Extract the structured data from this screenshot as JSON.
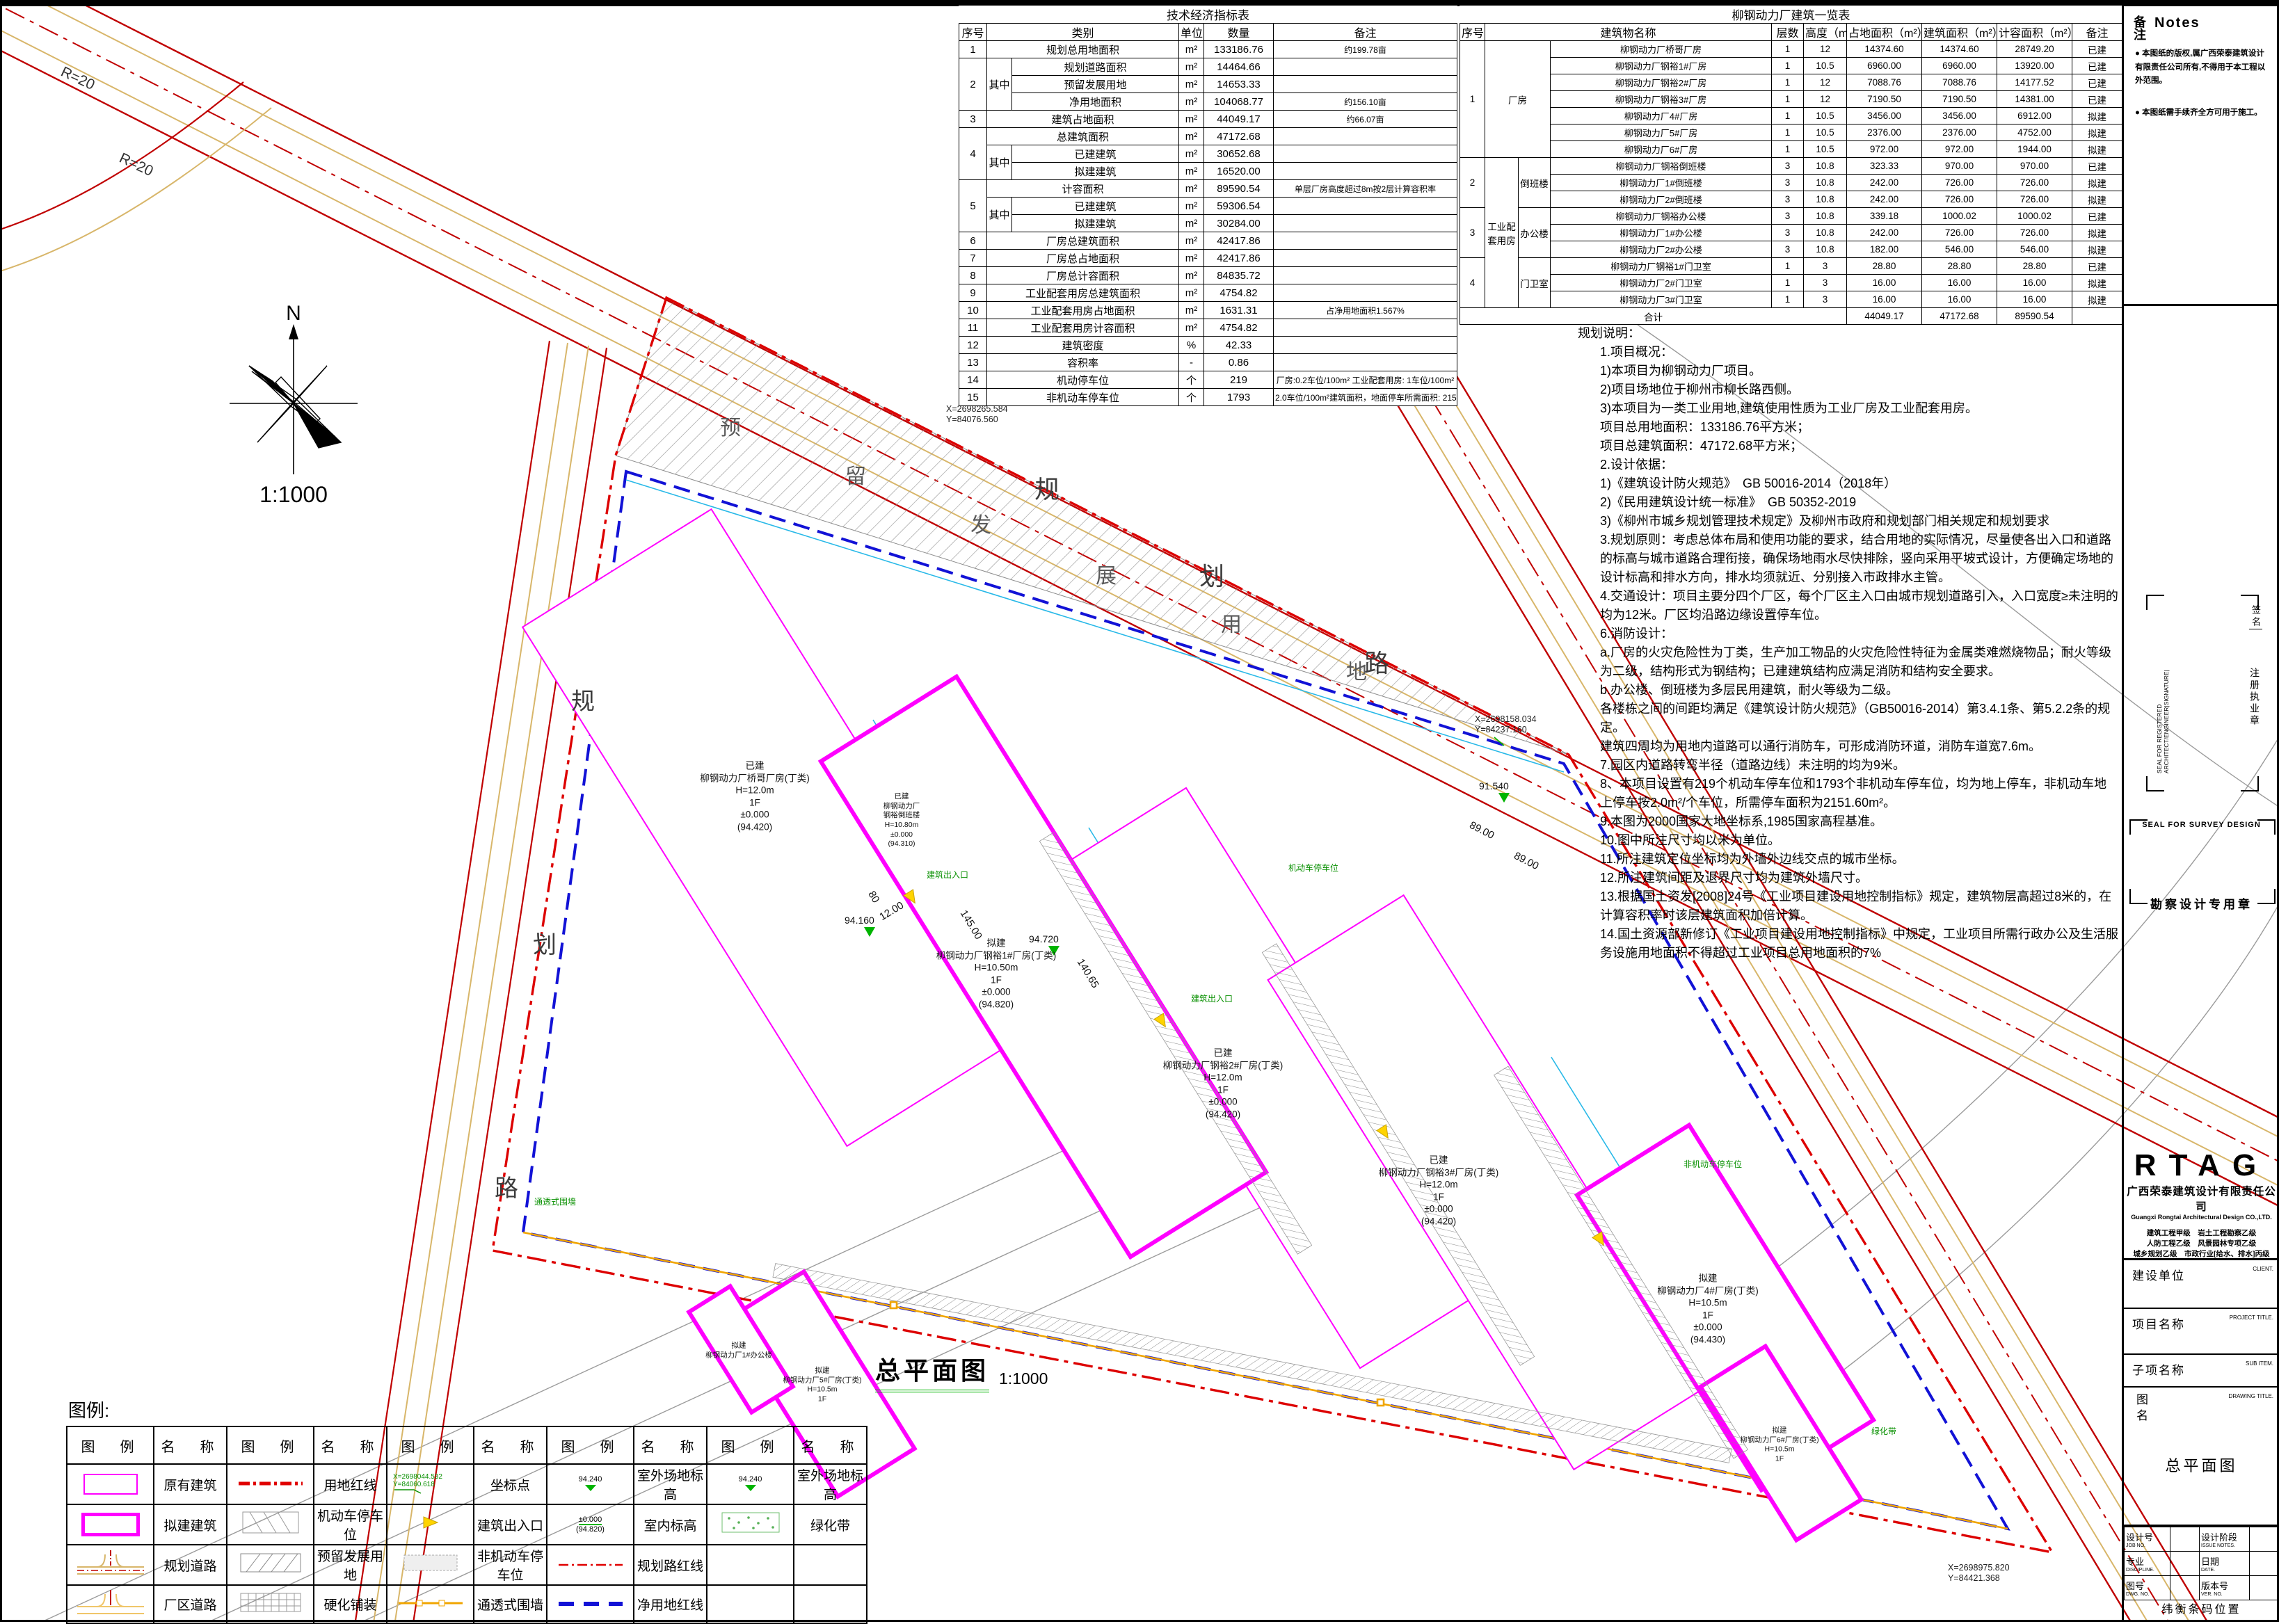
{
  "sheet": {
    "drawing_title": "总平面图",
    "drawing_scale": "1:1000",
    "north_label": "N",
    "compass_scale": "1:1000",
    "legend_title": "图例:",
    "accent_colors": {
      "existing_outline": "#ff00ff",
      "boundary_red": "#dd0000",
      "net_line_blue": "#1212d6",
      "dim_cyan": "#29b9e8",
      "elev_green": "#00b400",
      "road_tan": "#d8b66a"
    }
  },
  "t1": {
    "title": "技术经济指标表",
    "headers": {
      "no": "序号",
      "cat": "类别",
      "unit": "单位",
      "qty": "数量",
      "remark": "备注"
    },
    "rows": [
      {
        "no": "1",
        "sub": "",
        "name": "规划总用地面积",
        "unit": "m²",
        "qty": "133186.76",
        "remark": "约199.78亩"
      },
      {
        "no": "2",
        "sub": "其中",
        "name": "规划道路面积",
        "unit": "m²",
        "qty": "14464.66",
        "remark": ""
      },
      {
        "no": "",
        "sub": "",
        "name": "预留发展用地",
        "unit": "m²",
        "qty": "14653.33",
        "remark": ""
      },
      {
        "no": "",
        "sub": "",
        "name": "净用地面积",
        "unit": "m²",
        "qty": "104068.77",
        "remark": "约156.10亩"
      },
      {
        "no": "3",
        "sub": "",
        "name": "建筑占地面积",
        "unit": "m²",
        "qty": "44049.17",
        "remark": "约66.07亩"
      },
      {
        "no": "4",
        "sub": "",
        "name": "总建筑面积",
        "unit": "m²",
        "qty": "47172.68",
        "remark": ""
      },
      {
        "no": "",
        "sub": "其中",
        "name": "已建建筑",
        "unit": "m²",
        "qty": "30652.68",
        "remark": ""
      },
      {
        "no": "",
        "sub": "",
        "name": "拟建建筑",
        "unit": "m²",
        "qty": "16520.00",
        "remark": ""
      },
      {
        "no": "5",
        "sub": "",
        "name": "计容面积",
        "unit": "m²",
        "qty": "89590.54",
        "remark": "单层厂房高度超过8m按2层计算容积率"
      },
      {
        "no": "",
        "sub": "其中",
        "name": "已建建筑",
        "unit": "m²",
        "qty": "59306.54",
        "remark": ""
      },
      {
        "no": "",
        "sub": "",
        "name": "拟建建筑",
        "unit": "m²",
        "qty": "30284.00",
        "remark": ""
      },
      {
        "no": "6",
        "sub": "",
        "name": "厂房总建筑面积",
        "unit": "m²",
        "qty": "42417.86",
        "remark": ""
      },
      {
        "no": "7",
        "sub": "",
        "name": "厂房总占地面积",
        "unit": "m²",
        "qty": "42417.86",
        "remark": ""
      },
      {
        "no": "8",
        "sub": "",
        "name": "厂房总计容面积",
        "unit": "m²",
        "qty": "84835.72",
        "remark": ""
      },
      {
        "no": "9",
        "sub": "",
        "name": "工业配套用房总建筑面积",
        "unit": "m²",
        "qty": "4754.82",
        "remark": ""
      },
      {
        "no": "10",
        "sub": "",
        "name": "工业配套用房占地面积",
        "unit": "m²",
        "qty": "1631.31",
        "remark": "占净用地面积1.567%"
      },
      {
        "no": "11",
        "sub": "",
        "name": "工业配套用房计容面积",
        "unit": "m²",
        "qty": "4754.82",
        "remark": ""
      },
      {
        "no": "12",
        "sub": "",
        "name": "建筑密度",
        "unit": "%",
        "qty": "42.33",
        "remark": ""
      },
      {
        "no": "13",
        "sub": "",
        "name": "容积率",
        "unit": "-",
        "qty": "0.86",
        "remark": ""
      },
      {
        "no": "14",
        "sub": "",
        "name": "机动停车位",
        "unit": "个",
        "qty": "219",
        "remark": "厂房:0.2车位/100m²  工业配套用房: 1车位/100m²"
      },
      {
        "no": "15",
        "sub": "",
        "name": "非机动车停车位",
        "unit": "个",
        "qty": "1793",
        "remark": "2.0车位/100m²建筑面积，地面停车所需面积: 2151.60m²"
      }
    ]
  },
  "t2": {
    "title": "柳钢动力厂建筑一览表",
    "headers": {
      "no": "序号",
      "name": "建筑物名称",
      "floors": "层数",
      "height": "高度（m）",
      "occ": "占地面积（m²）",
      "gfa": "建筑面积（m²）",
      "far": "计容面积（m²）",
      "remark": "备注"
    },
    "groups": {
      "g1": "厂房",
      "g2": "工业配套用房",
      "s1": "倒班楼",
      "s2": "办公楼",
      "s3": "门卫室",
      "n1": "1",
      "n2": "2",
      "n3": "3",
      "n4": "4"
    },
    "rows": [
      {
        "name": "柳钢动力厂桥哥厂房",
        "floors": "1",
        "height": "12",
        "occ": "14374.60",
        "gfa": "14374.60",
        "far": "28749.20",
        "remark": "已建"
      },
      {
        "name": "柳钢动力厂钢裕1#厂房",
        "floors": "1",
        "height": "10.5",
        "occ": "6960.00",
        "gfa": "6960.00",
        "far": "13920.00",
        "remark": "已建"
      },
      {
        "name": "柳钢动力厂钢裕2#厂房",
        "floors": "1",
        "height": "12",
        "occ": "7088.76",
        "gfa": "7088.76",
        "far": "14177.52",
        "remark": "已建"
      },
      {
        "name": "柳钢动力厂钢裕3#厂房",
        "floors": "1",
        "height": "12",
        "occ": "7190.50",
        "gfa": "7190.50",
        "far": "14381.00",
        "remark": "已建"
      },
      {
        "name": "柳钢动力厂4#厂房",
        "floors": "1",
        "height": "10.5",
        "occ": "3456.00",
        "gfa": "3456.00",
        "far": "6912.00",
        "remark": "拟建"
      },
      {
        "name": "柳钢动力厂5#厂房",
        "floors": "1",
        "height": "10.5",
        "occ": "2376.00",
        "gfa": "2376.00",
        "far": "4752.00",
        "remark": "拟建"
      },
      {
        "name": "柳钢动力厂6#厂房",
        "floors": "1",
        "height": "10.5",
        "occ": "972.00",
        "gfa": "972.00",
        "far": "1944.00",
        "remark": "拟建"
      },
      {
        "name": "柳钢动力厂钢裕倒班楼",
        "floors": "3",
        "height": "10.8",
        "occ": "323.33",
        "gfa": "970.00",
        "far": "970.00",
        "remark": "已建"
      },
      {
        "name": "柳钢动力厂1#倒班楼",
        "floors": "3",
        "height": "10.8",
        "occ": "242.00",
        "gfa": "726.00",
        "far": "726.00",
        "remark": "拟建"
      },
      {
        "name": "柳钢动力厂2#倒班楼",
        "floors": "3",
        "height": "10.8",
        "occ": "242.00",
        "gfa": "726.00",
        "far": "726.00",
        "remark": "拟建"
      },
      {
        "name": "柳钢动力厂钢裕办公楼",
        "floors": "3",
        "height": "10.8",
        "occ": "339.18",
        "gfa": "1000.02",
        "far": "1000.02",
        "remark": "已建"
      },
      {
        "name": "柳钢动力厂1#办公楼",
        "floors": "3",
        "height": "10.8",
        "occ": "242.00",
        "gfa": "726.00",
        "far": "726.00",
        "remark": "拟建"
      },
      {
        "name": "柳钢动力厂2#办公楼",
        "floors": "3",
        "height": "10.8",
        "occ": "182.00",
        "gfa": "546.00",
        "far": "546.00",
        "remark": "拟建"
      },
      {
        "name": "柳钢动力厂钢裕1#门卫室",
        "floors": "1",
        "height": "3",
        "occ": "28.80",
        "gfa": "28.80",
        "far": "28.80",
        "remark": "已建"
      },
      {
        "name": "柳钢动力厂2#门卫室",
        "floors": "1",
        "height": "3",
        "occ": "16.00",
        "gfa": "16.00",
        "far": "16.00",
        "remark": "拟建"
      },
      {
        "name": "柳钢动力厂3#门卫室",
        "floors": "1",
        "height": "3",
        "occ": "16.00",
        "gfa": "16.00",
        "far": "16.00",
        "remark": "拟建"
      }
    ],
    "total": {
      "label": "合计",
      "occ": "44049.17",
      "gfa": "47172.68",
      "far": "89590.54"
    }
  },
  "pn": {
    "lines": [
      "规划说明：",
      "1.项目概况：",
      "1)本项目为柳钢动力厂项目。",
      "2)项目场地位于柳州市柳长路西侧。",
      "3)本项目为一类工业用地,建筑使用性质为工业厂房及工业配套用房。",
      "项目总用地面积：133186.76平方米；",
      "项目总建筑面积：47172.68平方米；",
      "2.设计依据：",
      "1)《建筑设计防火规范》　GB 50016-2014（2018年）",
      "2)《民用建筑设计统一标准》　GB 50352-2019",
      "3)《柳州市城乡规划管理技术规定》及柳州市政府和规划部门相关规定和规划要求",
      "3.规划原则：考虑总体布局和使用功能的要求，结合用地的实际情况，尽量使各出入口和道路的标高与城市道路合理衔接，确保场地雨水尽快排除，竖向采用平坡式设计，方便确定场地的设计标高和排水方向，排水均须就近、分别接入市政排水主管。",
      "4.交通设计：项目主要分四个厂区，每个厂区主入口由城市规划道路引入，入口宽度≥未注明的均为12米。厂区均沿路边缘设置停车位。",
      "6.消防设计：",
      "a.厂房的火灾危险性为丁类，生产加工物品的火灾危险性特征为金属类难燃烧物品；耐火等级为二级，结构形式为钢结构；已建建筑结构应满足消防和结构安全要求。",
      "b.办公楼、倒班楼为多层民用建筑，耐火等级为二级。",
      "各楼栋之间的间距均满足《建筑设计防火规范》（GB50016-2014）第3.4.1条、第5.2.2条的规定。",
      "建筑四周均为用地内道路可以通行消防车，可形成消防环道，消防车道宽7.6m。",
      "7.园区内道路转弯半径（道路边线）未注明的均为9米。",
      "8、本项目设置有219个机动车停车位和1793个非机动车停车位，均为地上停车，非机动车地上停车按2.0m²/个车位，所需停车面积为2151.60m²。",
      "9.本图为2000国家大地坐标系,1985国家高程基准。",
      "10.图中所注尺寸均以米为单位。",
      "11.所注建筑定位坐标均为外墙外边线交点的城市坐标。",
      "12.所注建筑间距及退界尺寸均为建筑外墙尺寸。",
      "13.根据国土资发[2008]24号《工业项目建设用地控制指标》规定，建筑物层高超过8米的，在计算容积率时该层建筑面积加倍计算。",
      "14.国土资源部新修订《工业项目建设用地控制指标》中规定，工业项目所需行政办公及生活服务设施用地面积不得超过工业项目总用地面积的7%"
    ]
  },
  "tb": {
    "notes_cn": "备注",
    "notes_en": "Notes",
    "note1": "本图纸的版权,属广西荣泰建筑设计有限责任公司所有,不得用于本工程以外范围。",
    "note2": "本图纸需手续齐全方可用于施工。",
    "seal_reg_en": "SEAL FOR REGISTERED ARCHITECT/ENGINEER|SIGNATURE|",
    "seal_reg_cn": "注册执业章",
    "sign_cn": "签名",
    "seal_survey_en": "SEAL FOR SURVEY DESIGN",
    "seal_survey_cn": "勘察设计专用章",
    "p1cn": "审定",
    "p1en": "APPROVED BY.",
    "p2cn": "审核",
    "p2en": "AUDIT.",
    "p3cn": "项目负责",
    "p3en": "PROJECT CHIEF.",
    "p4cn": "项目经理",
    "p4en": "PROJECT MANAGER.",
    "p5cn": "专业负责",
    "p5en": "DISCIPLINE CHIEF.",
    "p6cn": "工种负责",
    "p6en": "ARCH./ENGR.",
    "p7cn": "校对",
    "p7en": "CHECKED BY.",
    "p8cn": "设计",
    "p8en": "DESIGNED BY.",
    "logo": "RTAG",
    "company_cn": "广西荣泰建筑设计有限责任公司",
    "company_en": "Guangxi Rongtai Architectural Design CO.,LTD.",
    "cred1": "建筑工程甲级　岩土工程勘察乙级",
    "cred2": "人防工程乙级　风景园林专项乙级",
    "cred3": "城乡规划乙级　市政行业[给水、排水]丙级",
    "client_cn": "建设单位",
    "client_en": "CLIENT.",
    "project_cn": "项目名称",
    "project_en": "PROJECT TITLE.",
    "subitem_cn": "子项名称",
    "subitem_en": "SUB ITEM.",
    "dwgname_cn": "图名",
    "dwgname_en": "DRAWING TITLE.",
    "dwgname_val": "总平面图",
    "job_cn": "设计号",
    "job_en": "JOB NO.",
    "issue_cn": "设计阶段",
    "issue_en": "ISSUE NOTES.",
    "disc_cn": "专业",
    "disc_en": "DISCIPLINE.",
    "date_cn": "日期",
    "date_en": "DATE.",
    "dwgno_cn": "图号",
    "dwgno_en": "DWG. NO.",
    "ver_cn": "版本号",
    "ver_en": "VER. NO.",
    "barcode": "纬衡条码位置"
  },
  "lg": {
    "h_sym": "图　例",
    "h_name": "名　称",
    "p1": [
      "原有建筑",
      "拟建建筑",
      "规划道路",
      "厂区道路"
    ],
    "p2": [
      "用地红线",
      "机动车停车位",
      "预留发展用地",
      "硬化铺装"
    ],
    "p3": [
      "坐标点",
      "建筑出入口",
      "非机动车停车位",
      "通透式围墙"
    ],
    "p4": [
      "室外场地标高",
      "室内标高",
      "规划路红线",
      "净用地红线"
    ],
    "p5": [
      "室外场地标高",
      "绿化带",
      "",
      ""
    ],
    "coord_x": "X=2698044.532",
    "coord_y": "Y=84060.618",
    "lvl": "94.240",
    "indoor1": "±0.000",
    "indoor2": "(94.820)"
  },
  "plan": {
    "road_chars": [
      "规",
      "划",
      "路"
    ],
    "reserved_chars": [
      "预",
      "留",
      "发",
      "展",
      "用",
      "地"
    ],
    "r20": "R=20",
    "dims": {
      "d1": "145.00",
      "d2": "140.65",
      "d3": "80",
      "d4": "12.00",
      "d5": "89.00",
      "d6": "89.00"
    },
    "elev": {
      "e1": "94.160",
      "e2": "94.720",
      "e3": "91.540"
    },
    "coords": [
      {
        "x": "X=2698280.334",
        "y": "Y=84084.660"
      },
      {
        "x": "X=2698265.584",
        "y": "Y=84076.560"
      },
      {
        "x": "X=2698158.034",
        "y": "Y=84237.160"
      },
      {
        "x": "X=2698975.820",
        "y": "Y=84421.368"
      }
    ],
    "callouts": {
      "fence": "通透式围墙",
      "green": "绿化带",
      "parking": "机动车停车位",
      "bike": "非机动车停车位",
      "entry": "建筑出入口"
    },
    "buildings": [
      {
        "lines": [
          "已建",
          "柳钢动力厂桥哥厂房(丁类)",
          "H=12.0m",
          "1F",
          "±0.000",
          "(94.420)"
        ]
      },
      {
        "lines": [
          "拟建",
          "柳钢动力厂钢裕1#厂房(丁类)",
          "H=10.50m",
          "1F",
          "±0.000",
          "(94.820)"
        ]
      },
      {
        "lines": [
          "已建",
          "柳钢动力厂钢裕2#厂房(丁类)",
          "H=12.0m",
          "1F",
          "±0.000",
          "(94.420)"
        ]
      },
      {
        "lines": [
          "已建",
          "柳钢动力厂钢裕3#厂房(丁类)",
          "H=12.0m",
          "1F",
          "±0.000",
          "(94.420)"
        ]
      },
      {
        "lines": [
          "已建",
          "柳钢动力厂",
          "钢裕倒班楼",
          "H=10.80m",
          "±0.000",
          "(94.310)"
        ]
      },
      {
        "lines": [
          "拟建",
          "柳钢动力厂4#厂房(丁类)",
          "H=10.5m",
          "1F",
          "±0.000",
          "(94.430)"
        ]
      },
      {
        "lines": [
          "拟建",
          "柳钢动力厂5#厂房(丁类)",
          "H=10.5m",
          "1F"
        ]
      },
      {
        "lines": [
          "拟建",
          "柳钢动力厂6#厂房(丁类)",
          "H=10.5m",
          "1F"
        ]
      },
      {
        "lines": [
          "拟建",
          "柳钢动力厂1#办公楼",
          "H=10.8m",
          "3F"
        ]
      }
    ]
  }
}
